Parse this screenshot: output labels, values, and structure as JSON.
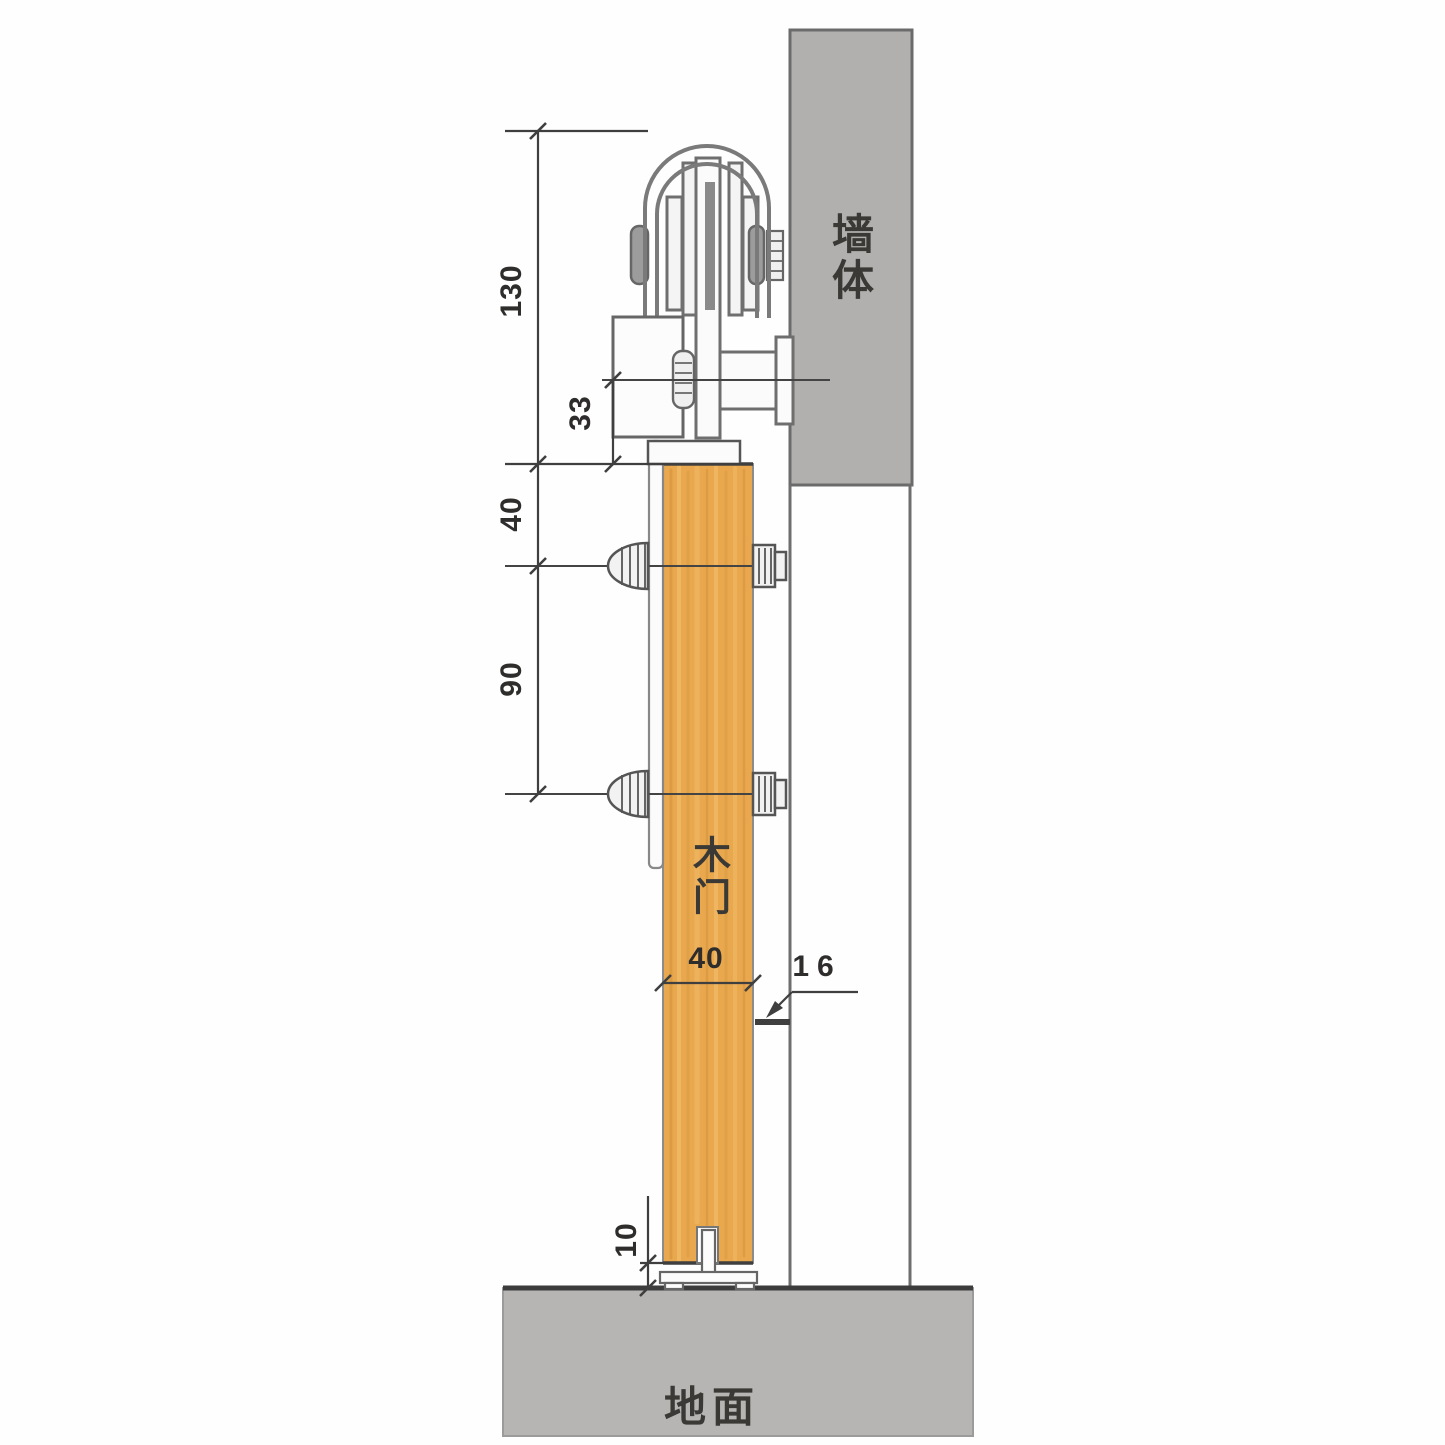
{
  "drawing": {
    "labels": {
      "wall": "墙体",
      "door": "木门",
      "floor": "地面"
    },
    "dimensions": {
      "track_assembly_height": "130",
      "bracket_bolt_to_door_top": "33",
      "door_top_to_first_bolt": "40",
      "bolt_spacing": "90",
      "door_thickness": "40",
      "door_to_wall_gap": "16",
      "floor_clearance": "10"
    },
    "colors": {
      "wall_fill": "#b1b0ae",
      "floor_fill": "#b6b5b3",
      "door_fill": "#e9a84e",
      "door_grain_dark": "#d3913a",
      "door_grain_light": "#f5c171",
      "outline_dark": "#3a3a3a",
      "hardware_gray": "#6a6a6a"
    }
  }
}
